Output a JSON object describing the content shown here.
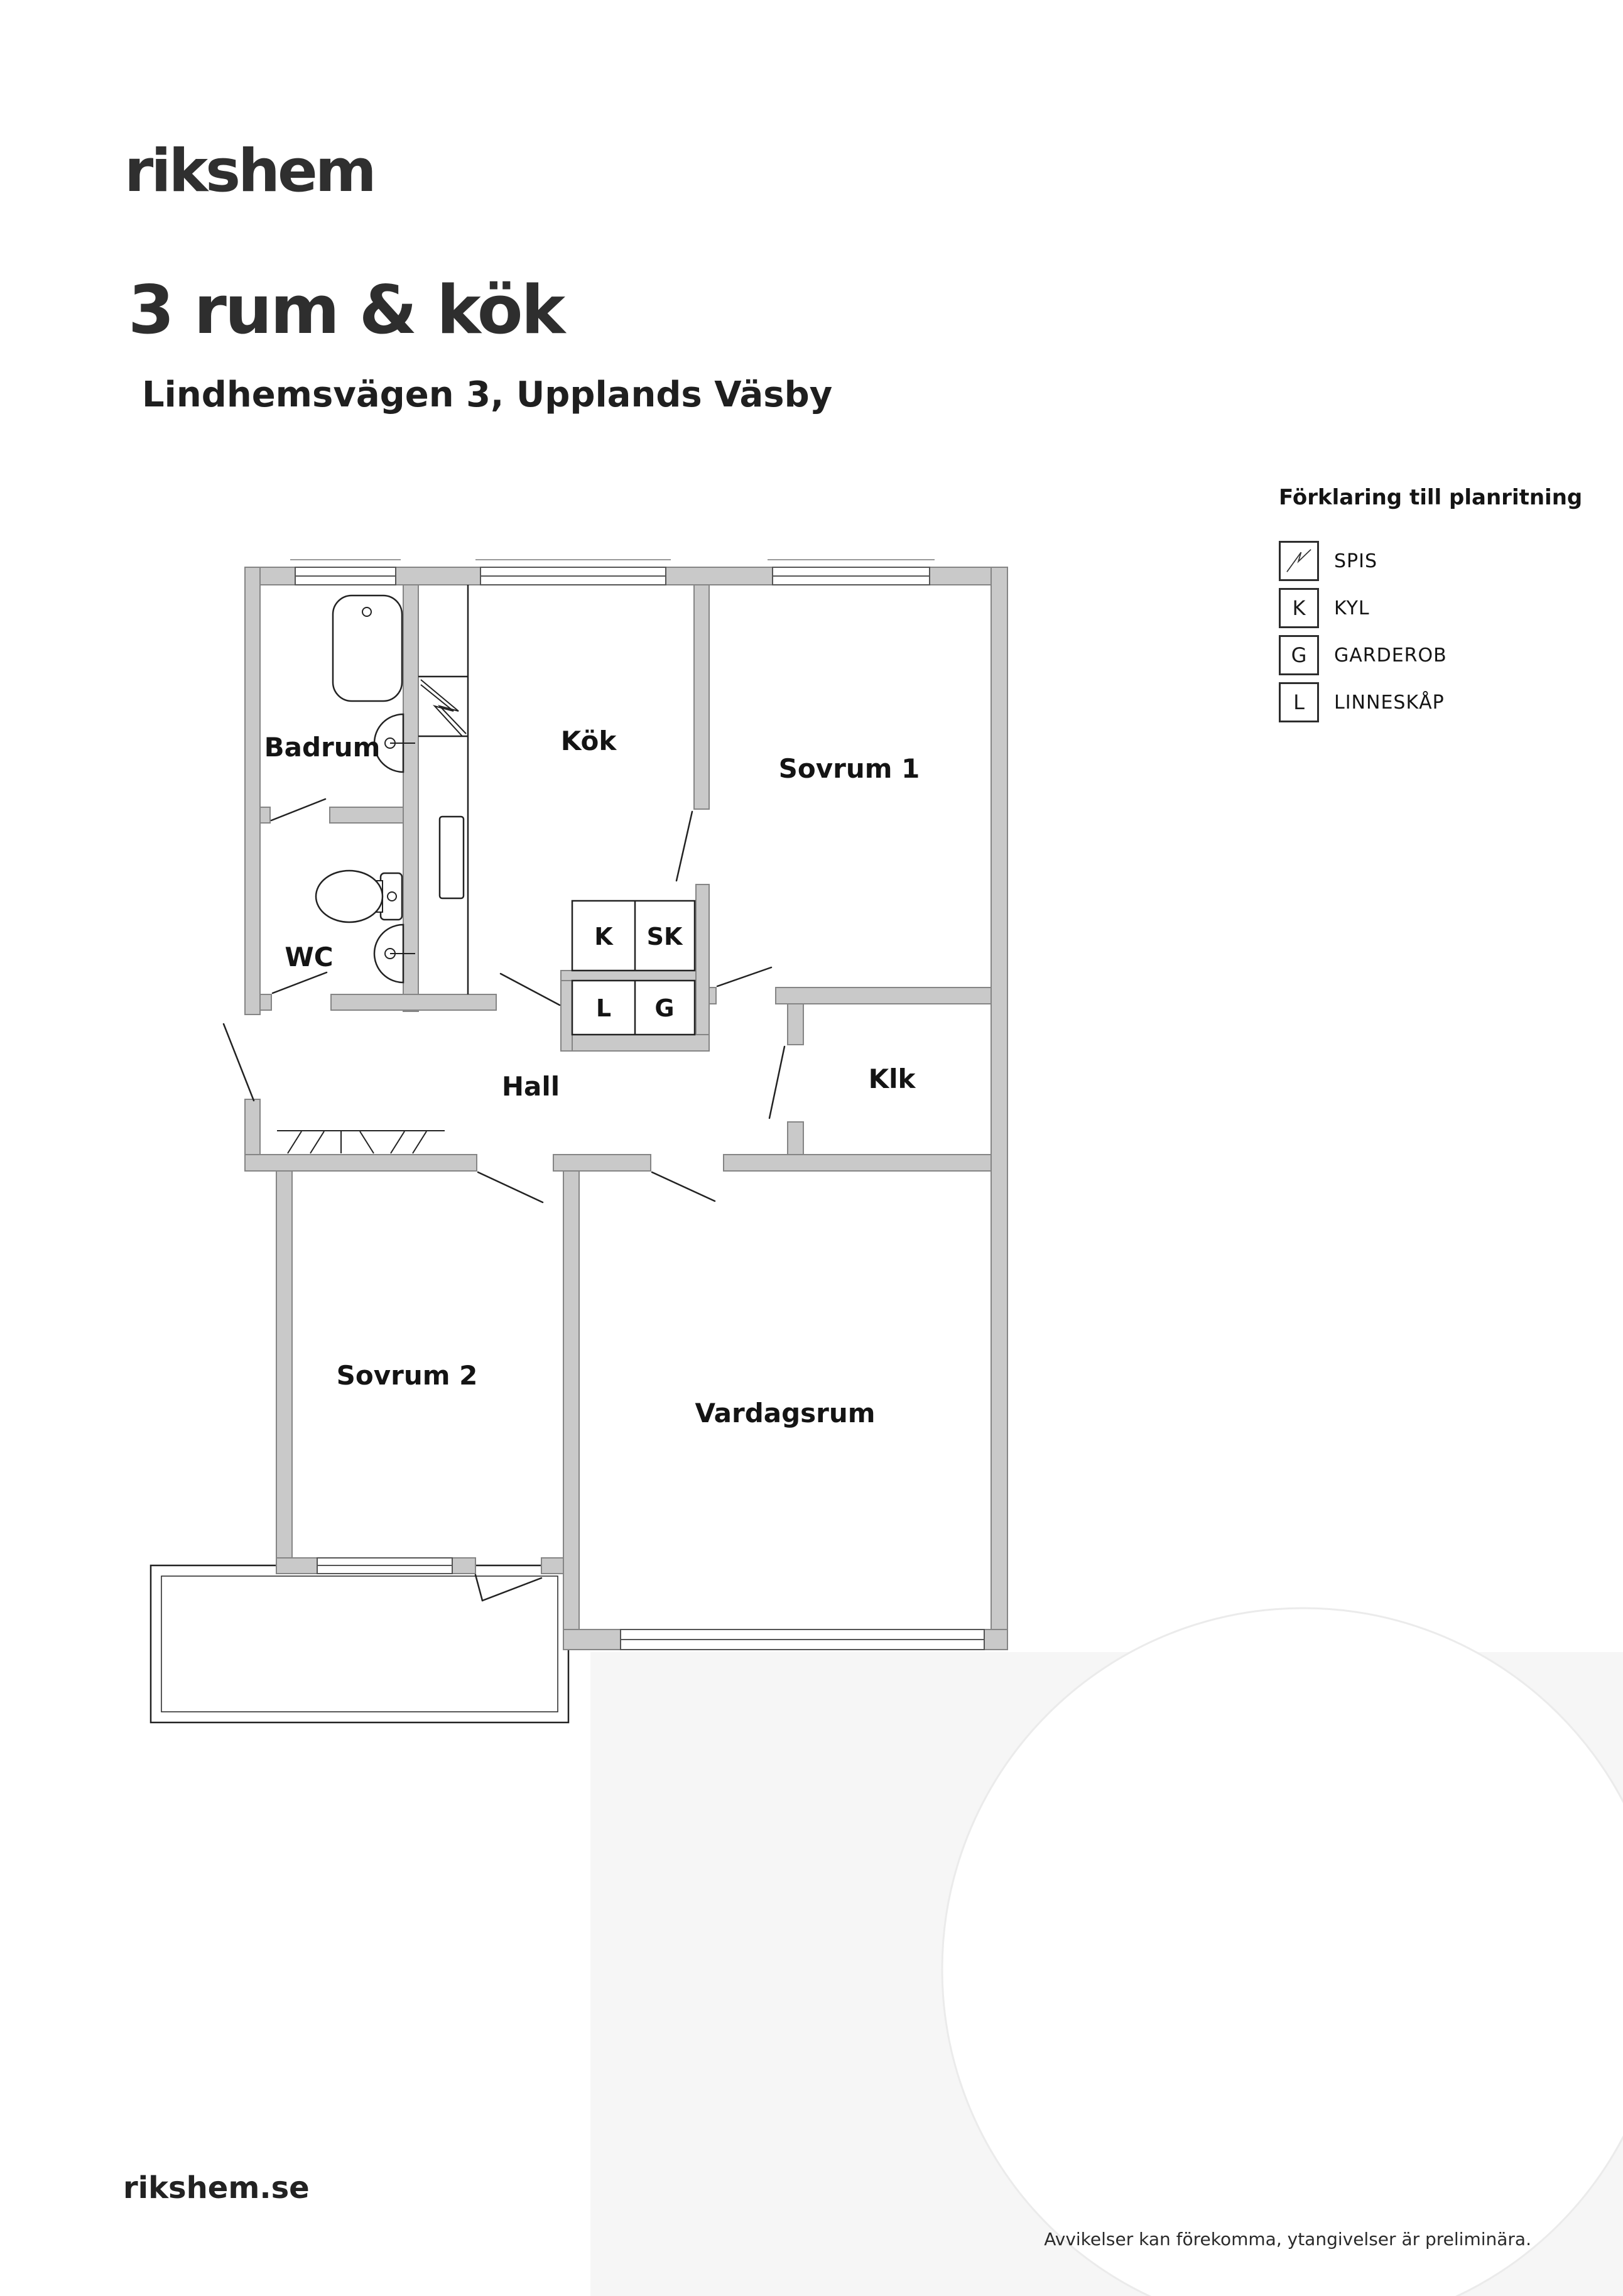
{
  "header": {
    "logo": "rikshem",
    "title": "3 rum & kök",
    "subtitle": "Lindhemsvägen 3, Upplands Väsby"
  },
  "legend": {
    "title": "Förklaring till planritning",
    "items": [
      {
        "symbol": "spis-zigzag",
        "letter": "",
        "label": "SPIS"
      },
      {
        "symbol": "letter-box",
        "letter": "K",
        "label": "KYL"
      },
      {
        "symbol": "letter-box",
        "letter": "G",
        "label": "GARDEROB"
      },
      {
        "symbol": "letter-box",
        "letter": "L",
        "label": "LINNESKÅP"
      }
    ]
  },
  "floorplan": {
    "rooms": [
      {
        "label": "Badrum"
      },
      {
        "label": "WC"
      },
      {
        "label": "Kök"
      },
      {
        "label": "Sovrum 1"
      },
      {
        "label": "Hall"
      },
      {
        "label": "Klk"
      },
      {
        "label": "Sovrum 2"
      },
      {
        "label": "Vardagsrum"
      }
    ],
    "closets": [
      {
        "label": "K"
      },
      {
        "label": "SK"
      },
      {
        "label": "L"
      },
      {
        "label": "G"
      }
    ]
  },
  "footer": {
    "website": "rikshem.se",
    "disclaimer": "Avvikelser kan förekomma, ytangivelser är preliminära."
  },
  "colors": {
    "wall_gray": "#c9c9c9",
    "wall_edge": "#858585",
    "line_dark": "#222222",
    "text_dark": "#141414",
    "wash_gray": "#f6f6f6"
  }
}
